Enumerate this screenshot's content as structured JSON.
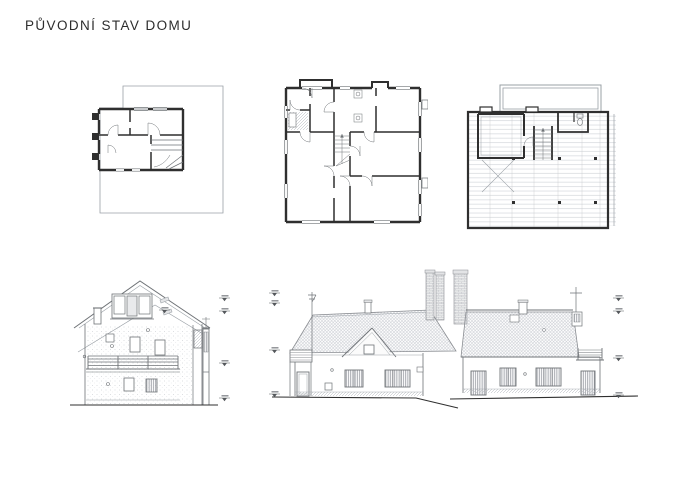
{
  "page": {
    "title": "PŮVODNÍ STAV DOMU",
    "background": "#ffffff"
  },
  "colors": {
    "wall_ink": "#2f2f2f",
    "line_medium": "#6f7377",
    "line_light": "#9aa0a6",
    "hatch_light": "#c7cad0",
    "brick_fill": "#eceded",
    "background": "#ffffff"
  },
  "figures": [
    {
      "name": "basement-floor-plan"
    },
    {
      "name": "ground-floor-plan"
    },
    {
      "name": "attic-floor-plan"
    },
    {
      "name": "side-elevation"
    },
    {
      "name": "front-elevation"
    },
    {
      "name": "rear-elevation"
    }
  ]
}
